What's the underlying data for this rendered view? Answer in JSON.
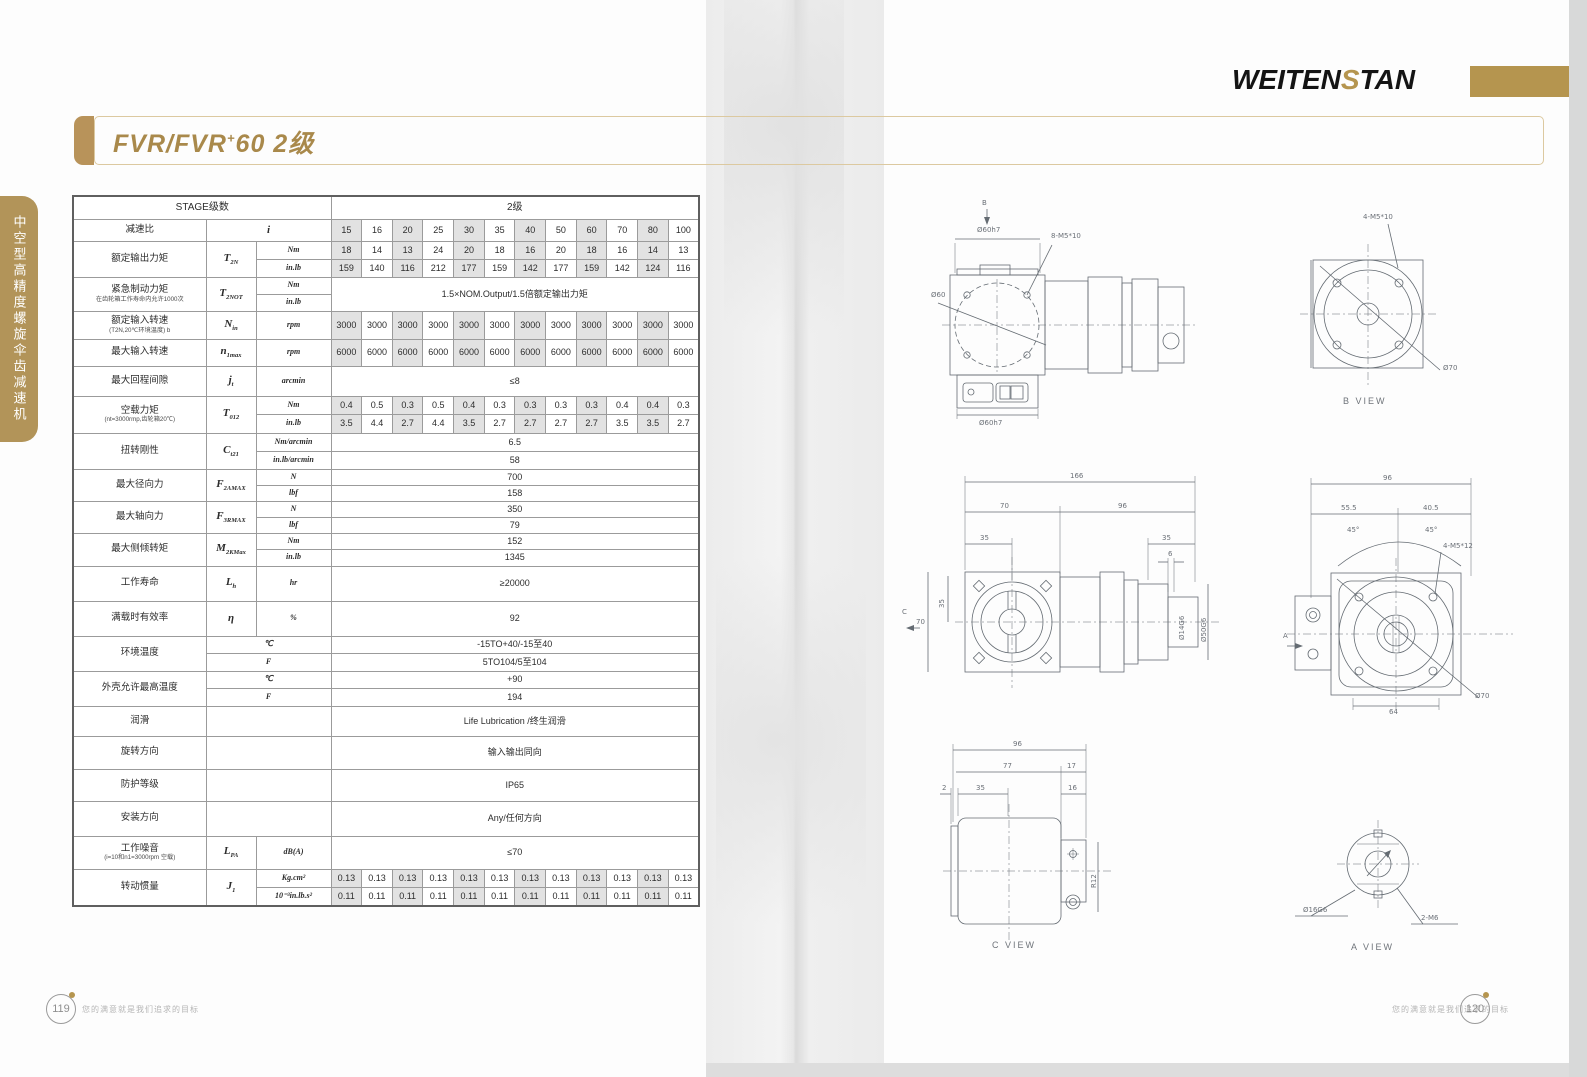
{
  "header": {
    "logo_pre": "WEITEN",
    "logo_s": "S",
    "logo_post": "TAN",
    "title_main": "FVR/FVR",
    "title_sup": "+",
    "title_rest": "60  2级"
  },
  "sidebar": {
    "vertical_label": "中空型高精度螺旋伞齿减速机"
  },
  "footer": {
    "left_num": "119",
    "right_num": "120",
    "slogan": "您的满意就是我们追求的目标"
  },
  "table": {
    "col_widths": [
      133,
      50,
      75,
      0,
      0,
      0,
      0,
      0,
      0,
      0,
      0,
      0,
      0,
      0,
      0
    ],
    "rows": [
      {
        "h": 23,
        "g": 1,
        "cells": [
          {
            "t": "STAGE级数",
            "c": 3,
            "k": "h"
          },
          {
            "t": "2级",
            "c": 12,
            "k": "h"
          }
        ]
      },
      {
        "h": 22,
        "g": 1,
        "cells": [
          {
            "t": "减速比",
            "k": "l"
          },
          {
            "t": "i",
            "c": 2,
            "k": "y"
          },
          {
            "vals": [
              "15",
              "16",
              "20",
              "25",
              "30",
              "35",
              "40",
              "50",
              "60",
              "70",
              "80",
              "100"
            ]
          }
        ]
      },
      {
        "h": 18,
        "g": 1,
        "cells": [
          {
            "t": "额定输出力矩",
            "r": 2,
            "k": "l"
          },
          {
            "t": "T",
            "s": "2N",
            "r": 2,
            "k": "y"
          },
          {
            "t": "Nm",
            "k": "u"
          },
          {
            "vals": [
              "18",
              "14",
              "13",
              "24",
              "20",
              "18",
              "16",
              "20",
              "18",
              "16",
              "14",
              "13"
            ]
          }
        ]
      },
      {
        "h": 18,
        "cells": [
          {
            "t": "in.lb",
            "k": "u"
          },
          {
            "vals": [
              "159",
              "140",
              "116",
              "212",
              "177",
              "159",
              "142",
              "177",
              "159",
              "142",
              "124",
              "116"
            ]
          }
        ]
      },
      {
        "h": 17,
        "g": 1,
        "cells": [
          {
            "t": "紧急制动力矩",
            "n": "在齿轮箱工作寿命内允许1000次",
            "r": 2,
            "k": "l"
          },
          {
            "t": "T",
            "s": "2NOT",
            "r": 2,
            "k": "y"
          },
          {
            "t": "Nm",
            "k": "u"
          },
          {
            "t": "1.5×NOM.Output/1.5倍额定输出力矩",
            "c": 12,
            "r": 2,
            "k": "m"
          }
        ]
      },
      {
        "h": 17,
        "cells": [
          {
            "t": "in.lb",
            "k": "u"
          }
        ]
      },
      {
        "h": 28,
        "g": 1,
        "cells": [
          {
            "t": "额定输入转速",
            "n": "(T2N,20℃环境温度) b",
            "k": "l"
          },
          {
            "t": "N",
            "s": "in",
            "k": "y"
          },
          {
            "t": "rpm",
            "k": "u"
          },
          {
            "vals": [
              "3000",
              "3000",
              "3000",
              "3000",
              "3000",
              "3000",
              "3000",
              "3000",
              "3000",
              "3000",
              "3000",
              "3000"
            ]
          }
        ]
      },
      {
        "h": 27,
        "g": 1,
        "cells": [
          {
            "t": "最大输入转速",
            "k": "l"
          },
          {
            "t": "n",
            "s": "1max",
            "k": "y"
          },
          {
            "t": "rpm",
            "k": "u"
          },
          {
            "vals": [
              "6000",
              "6000",
              "6000",
              "6000",
              "6000",
              "6000",
              "6000",
              "6000",
              "6000",
              "6000",
              "6000",
              "6000"
            ]
          }
        ]
      },
      {
        "h": 30,
        "g": 1,
        "cells": [
          {
            "t": "最大回程间隙",
            "k": "l"
          },
          {
            "t": "j",
            "s": "t",
            "k": "y"
          },
          {
            "t": "arcmin",
            "k": "u"
          },
          {
            "t": "≤8",
            "c": 12,
            "k": "m"
          }
        ]
      },
      {
        "h": 18,
        "g": 1,
        "cells": [
          {
            "t": "空载力矩",
            "n": "(nt=3000rmp,齿轮箱20℃)",
            "r": 2,
            "k": "l"
          },
          {
            "t": "T",
            "s": "012",
            "r": 2,
            "k": "y"
          },
          {
            "t": "Nm",
            "k": "u"
          },
          {
            "vals": [
              "0.4",
              "0.5",
              "0.3",
              "0.5",
              "0.4",
              "0.3",
              "0.3",
              "0.3",
              "0.3",
              "0.4",
              "0.4",
              "0.3"
            ]
          }
        ]
      },
      {
        "h": 19,
        "cells": [
          {
            "t": "in.lb",
            "k": "u"
          },
          {
            "vals": [
              "3.5",
              "4.4",
              "2.7",
              "4.4",
              "3.5",
              "2.7",
              "2.7",
              "2.7",
              "2.7",
              "3.5",
              "3.5",
              "2.7"
            ]
          }
        ]
      },
      {
        "h": 18,
        "g": 1,
        "cells": [
          {
            "t": "扭转刚性",
            "r": 2,
            "k": "l"
          },
          {
            "t": "C",
            "s": "t21",
            "r": 2,
            "k": "y"
          },
          {
            "t": "Nm/arcmin",
            "k": "u"
          },
          {
            "t": "6.5",
            "c": 12,
            "k": "m"
          }
        ]
      },
      {
        "h": 18,
        "cells": [
          {
            "t": "in.lb/arcmin",
            "k": "u"
          },
          {
            "t": "58",
            "c": 12,
            "k": "m"
          }
        ]
      },
      {
        "h": 16,
        "g": 1,
        "cells": [
          {
            "t": "最大径向力",
            "r": 2,
            "k": "l"
          },
          {
            "t": "F",
            "s": "2AMAX",
            "r": 2,
            "k": "y"
          },
          {
            "t": "N",
            "k": "u"
          },
          {
            "t": "700",
            "c": 12,
            "k": "m"
          }
        ]
      },
      {
        "h": 16,
        "cells": [
          {
            "t": "lbf",
            "k": "u"
          },
          {
            "t": "158",
            "c": 12,
            "k": "m"
          }
        ]
      },
      {
        "h": 16,
        "g": 1,
        "cells": [
          {
            "t": "最大轴向力",
            "r": 2,
            "k": "l"
          },
          {
            "t": "F",
            "s": "3RMAX",
            "r": 2,
            "k": "y"
          },
          {
            "t": "N",
            "k": "u"
          },
          {
            "t": "350",
            "c": 12,
            "k": "m"
          }
        ]
      },
      {
        "h": 16,
        "cells": [
          {
            "t": "lbf",
            "k": "u"
          },
          {
            "t": "79",
            "c": 12,
            "k": "m"
          }
        ]
      },
      {
        "h": 16,
        "g": 1,
        "cells": [
          {
            "t": "最大侧倾转矩",
            "r": 2,
            "k": "l"
          },
          {
            "t": "M",
            "s": "2KMax",
            "r": 2,
            "k": "y"
          },
          {
            "t": "Nm",
            "k": "u"
          },
          {
            "t": "152",
            "c": 12,
            "k": "m"
          }
        ]
      },
      {
        "h": 17,
        "cells": [
          {
            "t": "in.lb",
            "k": "u"
          },
          {
            "t": "1345",
            "c": 12,
            "k": "m"
          }
        ]
      },
      {
        "h": 35,
        "g": 1,
        "cells": [
          {
            "t": "工作寿命",
            "k": "l"
          },
          {
            "t": "L",
            "s": "h",
            "k": "y"
          },
          {
            "t": "hr",
            "k": "u"
          },
          {
            "t": "≥20000",
            "c": 12,
            "k": "m"
          }
        ]
      },
      {
        "h": 35,
        "g": 1,
        "cells": [
          {
            "t": "满载时有效率",
            "k": "l"
          },
          {
            "t": "η",
            "k": "y"
          },
          {
            "t": "%",
            "k": "u"
          },
          {
            "t": "92",
            "c": 12,
            "k": "m"
          }
        ]
      },
      {
        "h": 17,
        "g": 1,
        "cells": [
          {
            "t": "环境温度",
            "r": 2,
            "k": "l"
          },
          {
            "t": "℃",
            "c": 2,
            "k": "u"
          },
          {
            "t": "-15TO+40/-15至40",
            "c": 12,
            "k": "m"
          }
        ]
      },
      {
        "h": 18,
        "cells": [
          {
            "t": "F",
            "c": 2,
            "k": "u"
          },
          {
            "t": "5TO104/5至104",
            "c": 12,
            "k": "m"
          }
        ]
      },
      {
        "h": 17,
        "g": 1,
        "cells": [
          {
            "t": "外壳允许最高温度",
            "r": 2,
            "k": "l"
          },
          {
            "t": "℃",
            "c": 2,
            "k": "u"
          },
          {
            "t": "+90",
            "c": 12,
            "k": "m"
          }
        ]
      },
      {
        "h": 18,
        "cells": [
          {
            "t": "F",
            "c": 2,
            "k": "u"
          },
          {
            "t": "194",
            "c": 12,
            "k": "m"
          }
        ]
      },
      {
        "h": 30,
        "g": 1,
        "cells": [
          {
            "t": "润滑",
            "k": "l"
          },
          {
            "t": "",
            "c": 2,
            "k": "e"
          },
          {
            "t": "Life Lubrication /终生润滑",
            "c": 12,
            "k": "m"
          }
        ]
      },
      {
        "h": 33,
        "g": 1,
        "cells": [
          {
            "t": "旋转方向",
            "k": "l"
          },
          {
            "t": "",
            "c": 2,
            "k": "e"
          },
          {
            "t": "输入输出同向",
            "c": 12,
            "k": "m"
          }
        ]
      },
      {
        "h": 32,
        "g": 1,
        "cells": [
          {
            "t": "防护等级",
            "k": "l"
          },
          {
            "t": "",
            "c": 2,
            "k": "e"
          },
          {
            "t": "IP65",
            "c": 12,
            "k": "m"
          }
        ]
      },
      {
        "h": 35,
        "g": 1,
        "cells": [
          {
            "t": "安装方向",
            "k": "l"
          },
          {
            "t": "",
            "c": 2,
            "k": "e"
          },
          {
            "t": "Any/任何方向",
            "c": 12,
            "k": "m"
          }
        ]
      },
      {
        "h": 33,
        "g": 1,
        "cells": [
          {
            "t": "工作噪音",
            "n": "(i=10和n1=3000rpm 空载)",
            "k": "l"
          },
          {
            "t": "L",
            "s": "PA",
            "k": "y"
          },
          {
            "t": "dB(A)",
            "k": "u"
          },
          {
            "t": "≤70",
            "c": 12,
            "k": "m"
          }
        ]
      },
      {
        "h": 18,
        "g": 1,
        "cells": [
          {
            "t": "转动惯量",
            "r": 2,
            "k": "l"
          },
          {
            "t": "J",
            "s": "1",
            "r": 2,
            "k": "y"
          },
          {
            "t": "Kg.cm²",
            "k": "u"
          },
          {
            "vals": [
              "0.13",
              "0.13",
              "0.13",
              "0.13",
              "0.13",
              "0.13",
              "0.13",
              "0.13",
              "0.13",
              "0.13",
              "0.13",
              "0.13"
            ]
          }
        ]
      },
      {
        "h": 19,
        "cells": [
          {
            "t": "10⁻³in.lb.s²",
            "k": "u"
          },
          {
            "vals": [
              "0.11",
              "0.11",
              "0.11",
              "0.11",
              "0.11",
              "0.11",
              "0.11",
              "0.11",
              "0.11",
              "0.11",
              "0.11",
              "0.11"
            ]
          }
        ]
      }
    ]
  },
  "drawings": {
    "d1": {
      "view_arrow": "B",
      "dim_top": "Ø60h7",
      "bolt": "8-M5*10",
      "dia_left": "Ø60",
      "dim_bottom": "Ø60h7"
    },
    "d2": {
      "bolt": "4-M5*10",
      "dia": "Ø70",
      "caption": "B VIEW"
    },
    "d3": {
      "w166": "166",
      "w70": "70",
      "w96": "96",
      "w35l": "35",
      "w35r": "35",
      "w6": "6",
      "h70": "70",
      "h35": "35",
      "view_arrow": "C",
      "dia14": "Ø14G6",
      "dia50": "Ø50G6"
    },
    "d4": {
      "w96": "96",
      "w555": "55.5",
      "w405": "40.5",
      "a45l": "45°",
      "a45r": "45°",
      "bolt": "4-M5*12",
      "dia": "Ø70",
      "w64": "64",
      "view_arrow": "A"
    },
    "d5": {
      "w96": "96",
      "w77": "77",
      "w17": "17",
      "w2": "2",
      "w35": "35",
      "w16": "16",
      "r12": "R12",
      "caption": "C VIEW"
    },
    "d6": {
      "dia": "Ø16G6",
      "bolt": "2-M6",
      "caption": "A VIEW"
    }
  }
}
